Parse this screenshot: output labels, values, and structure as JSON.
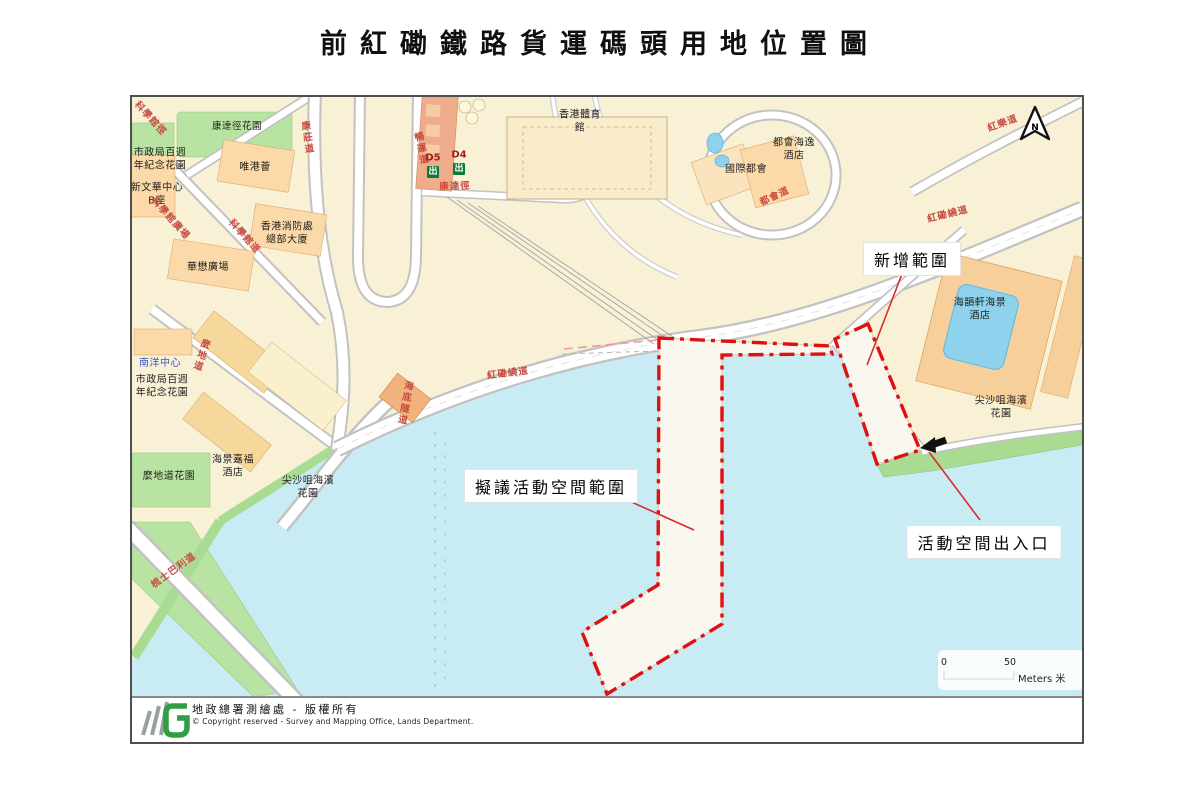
{
  "title": "前紅磡鐵路貨運碼頭用地位置圖",
  "annotations": {
    "new_area": "新增範圍",
    "proposed_space": "擬議活動空間範圍",
    "entrance": "活動空間出入口"
  },
  "north_label": "N",
  "scale_bar": {
    "start": "0",
    "end": "50",
    "unit": "Meters 米"
  },
  "roads": {
    "science_museum_path": "科學館徑",
    "science_museum_square": "科學館廣場",
    "science_museum_road": "科學館道",
    "hong_chong_road": "康莊道",
    "cheong_wan_road": "暢運道",
    "hong_tat_path": "康達徑",
    "metropolis_drive": "都會道",
    "hung_lok_road": "紅樂道",
    "hung_hom_bypass": "紅磡繞道",
    "cross_harbour_tunnel": "海底隧道",
    "mody_road": "麼地道",
    "salisbury_road": "梳士巴利道"
  },
  "places": {
    "tat_path_garden": "康達徑花園",
    "urban_council_garden": "市政局百週\n年紀念花園",
    "new_mandarin_plaza": "新文華中心\nB座",
    "hotel_icon": "唯港薈",
    "fire_services_hq": "香港消防處\n總部大廈",
    "chinachem_plaza": "華懋廣場",
    "hk_coliseum": "香港體育\n館",
    "exit_d5": "D5",
    "exit_d4": "D4",
    "exit_glyph": "出",
    "harbour_plaza_metropolis": "都會海逸\n酒店",
    "international_metropolis": "國際都會",
    "harbourfront_horizon_hotel": "海韻軒海景\n酒店",
    "tst_promenade": "尖沙咀海濱\n花園",
    "nanyang_centre": "南洋中心",
    "grand_stanford_hotel": "海景嘉福\n酒店",
    "mody_road_garden": "麼地道花園"
  },
  "credit": {
    "zh": "地政總署測繪處 - 版權所有",
    "en": "© Copyright reserved - Survey and Mapping Office, Lands Department."
  },
  "colors": {
    "boundary_red": "#dd1111",
    "road_label_red": "#c84b42",
    "water": "#c9ecf4",
    "land": "#f9f1d6",
    "park_green": "#b9e3a2",
    "exit_green": "#0e7a38",
    "station_orange": "#eeac8a"
  }
}
